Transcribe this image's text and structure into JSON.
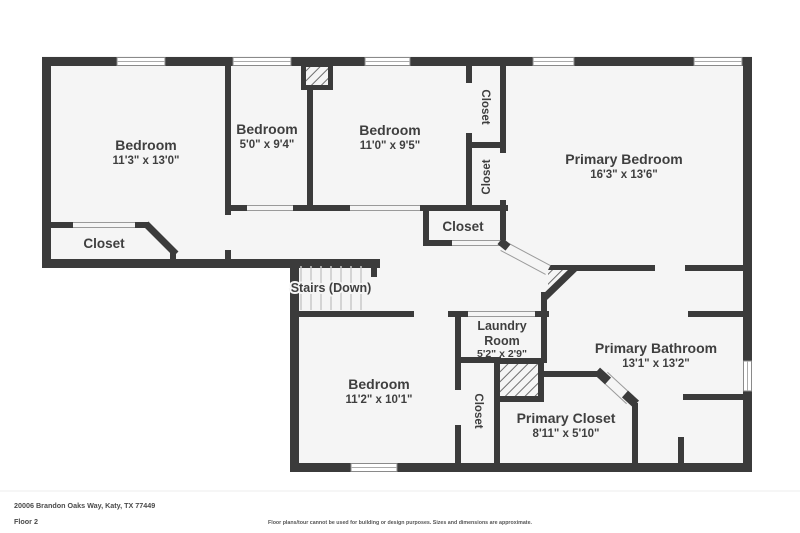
{
  "colors": {
    "wall": "#3b3b3b",
    "floor": "#f5f5f5",
    "label": "#3f3f3f",
    "tread_line": "#c9c9c9",
    "window_border": "#8a8a8a",
    "hatch": "#6f6f6f"
  },
  "plan": {
    "rooms": {
      "bedroom1": {
        "name": "Bedroom",
        "dims": "11'3\" x 13'0\""
      },
      "bedroom2": {
        "name": "Bedroom",
        "dims": "5'0\" x 9'4\""
      },
      "bedroom3": {
        "name": "Bedroom",
        "dims": "11'0\" x 9'5\""
      },
      "primary_bedroom": {
        "name": "Primary Bedroom",
        "dims": "16'3\" x 13'6\""
      },
      "bedroom1_closet": {
        "name": "Closet"
      },
      "closet_upper": {
        "name": "Closet"
      },
      "closet_lower": {
        "name": "Closet"
      },
      "hall_closet": {
        "name": "Closet"
      },
      "stairs": {
        "name": "Stairs (Down)"
      },
      "laundry": {
        "line1": "Laundry",
        "line2": "Room",
        "dims": "5'2\" x 2'9\""
      },
      "bedroom4": {
        "name": "Bedroom",
        "dims": "11'2\" x 10'1\""
      },
      "bedroom4_closet": {
        "name": "Closet"
      },
      "primary_bathroom": {
        "name": "Primary Bathroom",
        "dims": "13'1\" x 13'2\""
      },
      "primary_closet": {
        "name": "Primary Closet",
        "dims": "8'11\" x 5'10\""
      }
    }
  },
  "footer": {
    "address": "20006 Brandon Oaks Way, Katy, TX 77449",
    "floor_label": "Floor 2",
    "disclaimer": "Floor plans/tour cannot be used for building or design purposes. Sizes and dimensions are approximate."
  }
}
